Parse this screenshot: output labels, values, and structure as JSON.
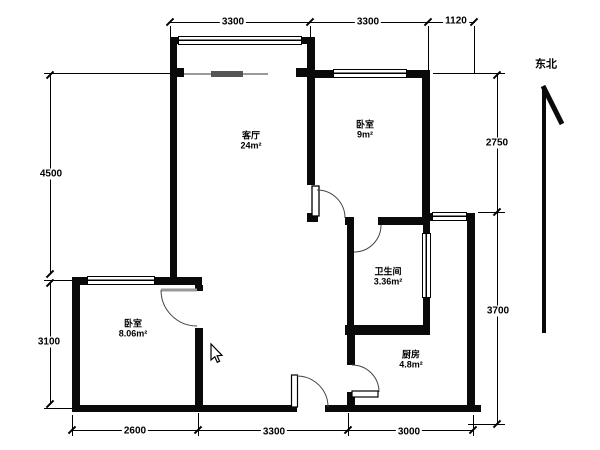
{
  "title": "apartment-floor-plan",
  "colors": {
    "wall": "#0a0a0a",
    "dimension_line": "#000000",
    "beam": "#999999",
    "beam_dark": "#555555",
    "door_arc": "#444444",
    "background": "#ffffff"
  },
  "rooms": [
    {
      "id": "living-room",
      "name": "客厅",
      "area": "24m²"
    },
    {
      "id": "bedroom-top",
      "name": "卧室",
      "area": "9m²"
    },
    {
      "id": "bedroom-left",
      "name": "卧室",
      "area": "8.06m²"
    },
    {
      "id": "bathroom",
      "name": "卫生间",
      "area": "3.36m²"
    },
    {
      "id": "kitchen",
      "name": "厨房",
      "area": "4.8m²"
    }
  ],
  "dimensions": {
    "top": [
      "3300",
      "3300",
      "1120"
    ],
    "left": [
      "4500",
      "3100"
    ],
    "right": [
      "2750",
      "3700"
    ],
    "bottom": [
      "2600",
      "3300",
      "3000"
    ]
  },
  "compass": {
    "label": "东北"
  }
}
